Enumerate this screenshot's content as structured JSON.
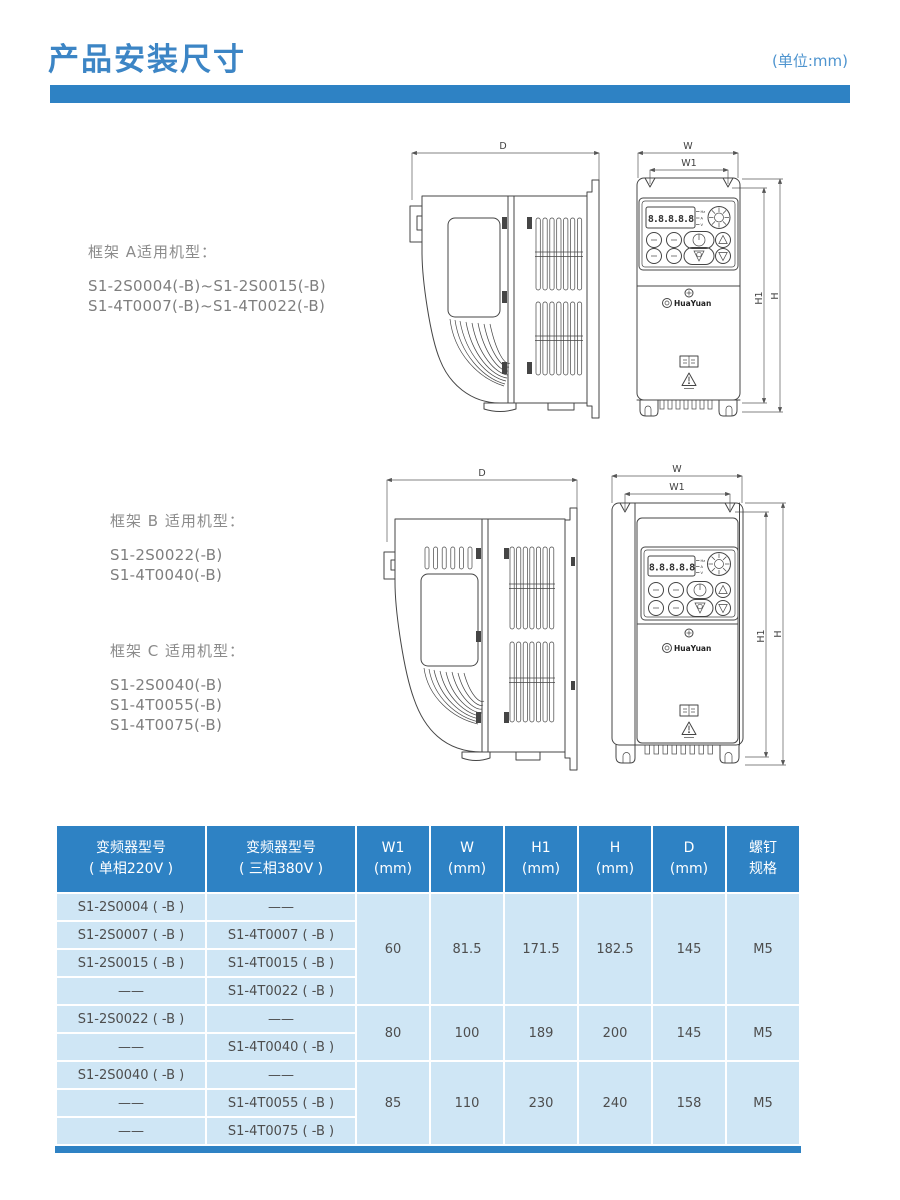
{
  "page": {
    "title": "产品安装尺寸",
    "unit_label": "(单位:mm)"
  },
  "frames": {
    "a": {
      "label": "框架 A适用机型：",
      "models": [
        "S1-2S0004(-B)~S1-2S0015(-B)",
        "S1-4T0007(-B)~S1-4T0022(-B)"
      ]
    },
    "b": {
      "label": "框架 B 适用机型：",
      "models": [
        "S1-2S0022(-B)",
        "S1-4T0040(-B)"
      ]
    },
    "c": {
      "label": "框架 C 适用机型：",
      "models": [
        "S1-2S0040(-B)",
        "S1-4T0055(-B)",
        "S1-4T0075(-B)"
      ]
    }
  },
  "drawing": {
    "dims": {
      "d": "D",
      "w": "W",
      "w1": "W1",
      "h": "H",
      "h1": "H1"
    },
    "display_text": "8.8.8.8.8",
    "indicators": [
      "Hz",
      "A",
      "V"
    ],
    "brand": "HuaYuan"
  },
  "table": {
    "headers": [
      {
        "line1": "变频器型号",
        "line2": "( 单相220V )"
      },
      {
        "line1": "变频器型号",
        "line2": "( 三相380V )"
      },
      {
        "line1": "W1",
        "line2": "(mm)"
      },
      {
        "line1": "W",
        "line2": "(mm)"
      },
      {
        "line1": "H1",
        "line2": "(mm)"
      },
      {
        "line1": "H",
        "line2": "(mm)"
      },
      {
        "line1": "D",
        "line2": "(mm)"
      },
      {
        "line1": "螺钉",
        "line2": "规格"
      }
    ],
    "groups": [
      {
        "rows": [
          {
            "m220": "S1-2S0004 ( -B )",
            "m380": "——"
          },
          {
            "m220": "S1-2S0007 ( -B )",
            "m380": "S1-4T0007 ( -B )"
          },
          {
            "m220": "S1-2S0015 ( -B )",
            "m380": "S1-4T0015 ( -B )"
          },
          {
            "m220": "——",
            "m380": "S1-4T0022 ( -B )"
          }
        ],
        "dims": {
          "w1": "60",
          "w": "81.5",
          "h1": "171.5",
          "h": "182.5",
          "d": "145",
          "screw": "M5"
        }
      },
      {
        "rows": [
          {
            "m220": "S1-2S0022 ( -B )",
            "m380": "——"
          },
          {
            "m220": "——",
            "m380": "S1-4T0040 ( -B )"
          }
        ],
        "dims": {
          "w1": "80",
          "w": "100",
          "h1": "189",
          "h": "200",
          "d": "145",
          "screw": "M5"
        }
      },
      {
        "rows": [
          {
            "m220": "S1-2S0040 ( -B )",
            "m380": "——"
          },
          {
            "m220": "——",
            "m380": "S1-4T0055 ( -B )"
          },
          {
            "m220": "——",
            "m380": "S1-4T0075 ( -B )"
          }
        ],
        "dims": {
          "w1": "85",
          "w": "110",
          "h1": "230",
          "h": "240",
          "d": "158",
          "screw": "M5"
        }
      }
    ]
  },
  "colors": {
    "accent_blue": "#2e82c4",
    "title_blue": "#3c85c5",
    "body_light_blue": "#cfe6f5"
  }
}
